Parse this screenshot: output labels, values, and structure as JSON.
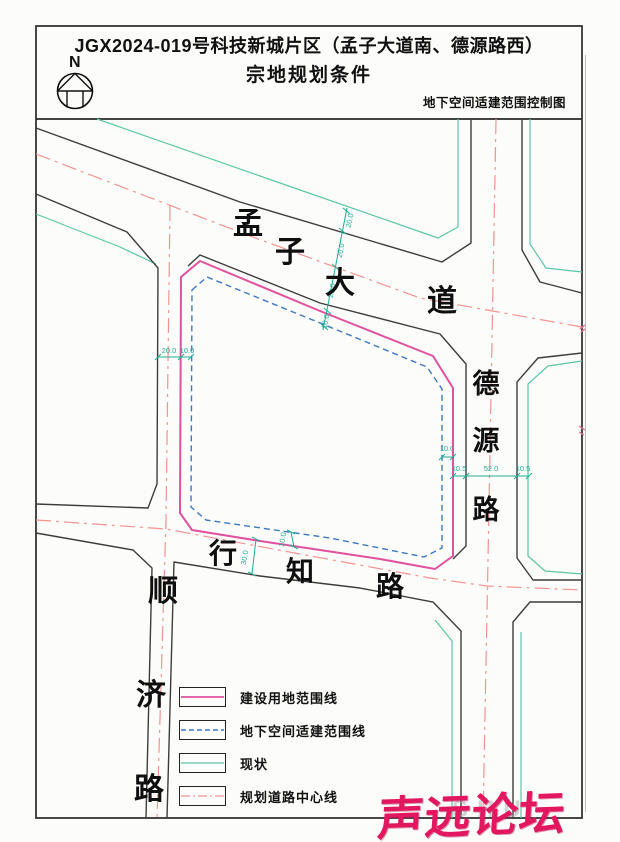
{
  "page": {
    "paper_color": "#fcfcfa"
  },
  "title": {
    "line1": "JGX2024-019号科技新城片区（孟子大道南、德源路西）",
    "line2": "宗地规划条件",
    "subtitle": "地下空间适建范围控制图",
    "north_label": "N"
  },
  "roads": {
    "mengzi_dadao": [
      "孟",
      "子",
      "大",
      "道"
    ],
    "deyuan_lu": [
      "德",
      "源",
      "路"
    ],
    "xingzhi_lu": [
      "行",
      "知",
      "路"
    ],
    "shunji_lu": [
      "顺",
      "济",
      "路"
    ]
  },
  "dimensions": {
    "mengzi_cross": [
      "20.0",
      "20.0",
      "20.0",
      "10.0"
    ],
    "west_edge": [
      "20.0",
      "10.0"
    ],
    "xingzhi_edge": [
      "30.0",
      "10.0"
    ],
    "east_edge": [
      "10.0",
      "10.5",
      "52.0",
      "10.5"
    ]
  },
  "legend": {
    "items": [
      {
        "label": "建设用地范围线",
        "color": "#e0519f",
        "pattern": "solid"
      },
      {
        "label": "地下空间适建范围线",
        "color": "#3d79c0",
        "pattern": "dashed"
      },
      {
        "label": "现状",
        "color": "#5bc7a6",
        "pattern": "solid"
      },
      {
        "label": "规划道路中心线",
        "color": "#f19392",
        "pattern": "dashdot"
      }
    ]
  },
  "watermark": {
    "text": "声远论坛",
    "ghost": "SHU",
    "color": "#e3175f"
  },
  "palette": {
    "road_edge": "#3d3d3d",
    "existing_teal": "#5bc7a6",
    "centerline_red": "#f19392",
    "parcel_pink": "#e0519f",
    "underground_blue": "#3d79c0",
    "dimension_teal": "#1fae93"
  }
}
